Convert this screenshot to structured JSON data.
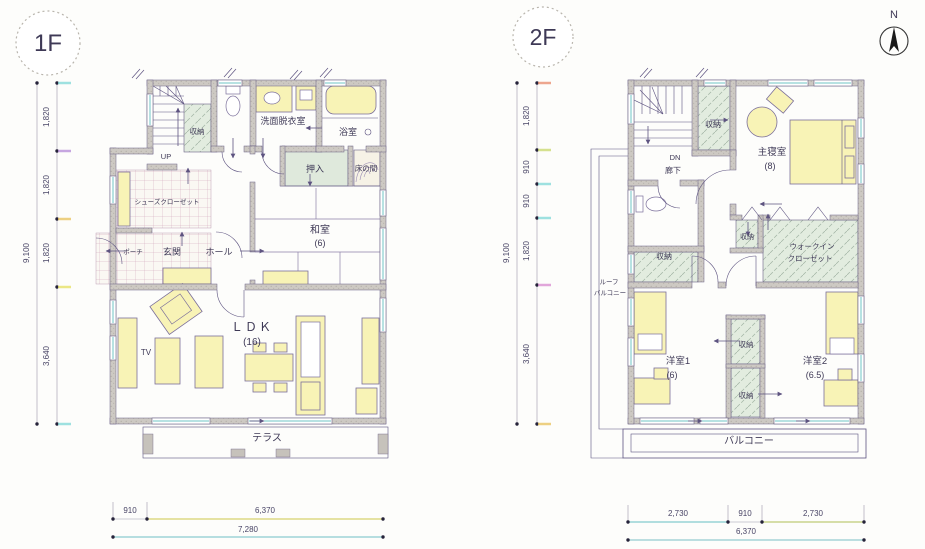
{
  "compass": {
    "label": "N"
  },
  "colors": {
    "line": "#5d5380",
    "wall_fill": "#cdc9c3",
    "furniture_fill": "#f8f3b6",
    "storage_fill": "#e2ecdf",
    "tile_line": "#cf9fb8",
    "paper": "#fdfdfb"
  },
  "floor1": {
    "badge": "1F",
    "rooms": {
      "stairs": "UP",
      "storage": "収納",
      "washroom": "洗面脱衣室",
      "bath": "浴室",
      "closet": "押入",
      "tokonoma": "床の間",
      "shoe_closet": "シューズクローゼット",
      "porch": "ポーチ",
      "entrance": "玄関",
      "hall": "ホール",
      "japanese_room": "和室",
      "japanese_room_size": "(6)",
      "ldk": "ＬＤＫ",
      "ldk_size": "(16)",
      "tv": "TV",
      "terrace": "テラス"
    },
    "dims": {
      "left_segments": [
        "1,820",
        "1,820",
        "1,820",
        "3,640"
      ],
      "left_total": "9,100",
      "bottom_segments": [
        "910",
        "6,370"
      ],
      "bottom_total": "7,280"
    }
  },
  "floor2": {
    "badge": "2F",
    "rooms": {
      "stairs": "DN",
      "corridor": "廊下",
      "storage_by_stairs": "収納",
      "master_bedroom": "主寝室",
      "master_bedroom_size": "(8)",
      "storage_left": "収納",
      "storage_master": "収納",
      "walkin_line1": "ウォークイン",
      "walkin_line2": "クローゼット",
      "roof_balcony_line1": "ルーフ",
      "roof_balcony_line2": "バルコニー",
      "western_room1": "洋室1",
      "western_room1_size": "(6)",
      "storage_mid_upper": "収納",
      "storage_mid_lower": "収納",
      "western_room2": "洋室2",
      "western_room2_size": "(6.5)",
      "balcony": "バルコニー"
    },
    "dims": {
      "left_segments": [
        "1,820",
        "910",
        "910",
        "1,820",
        "3,640"
      ],
      "left_total": "9,100",
      "bottom_segments": [
        "2,730",
        "910",
        "2,730"
      ],
      "bottom_total": "6,370"
    }
  }
}
